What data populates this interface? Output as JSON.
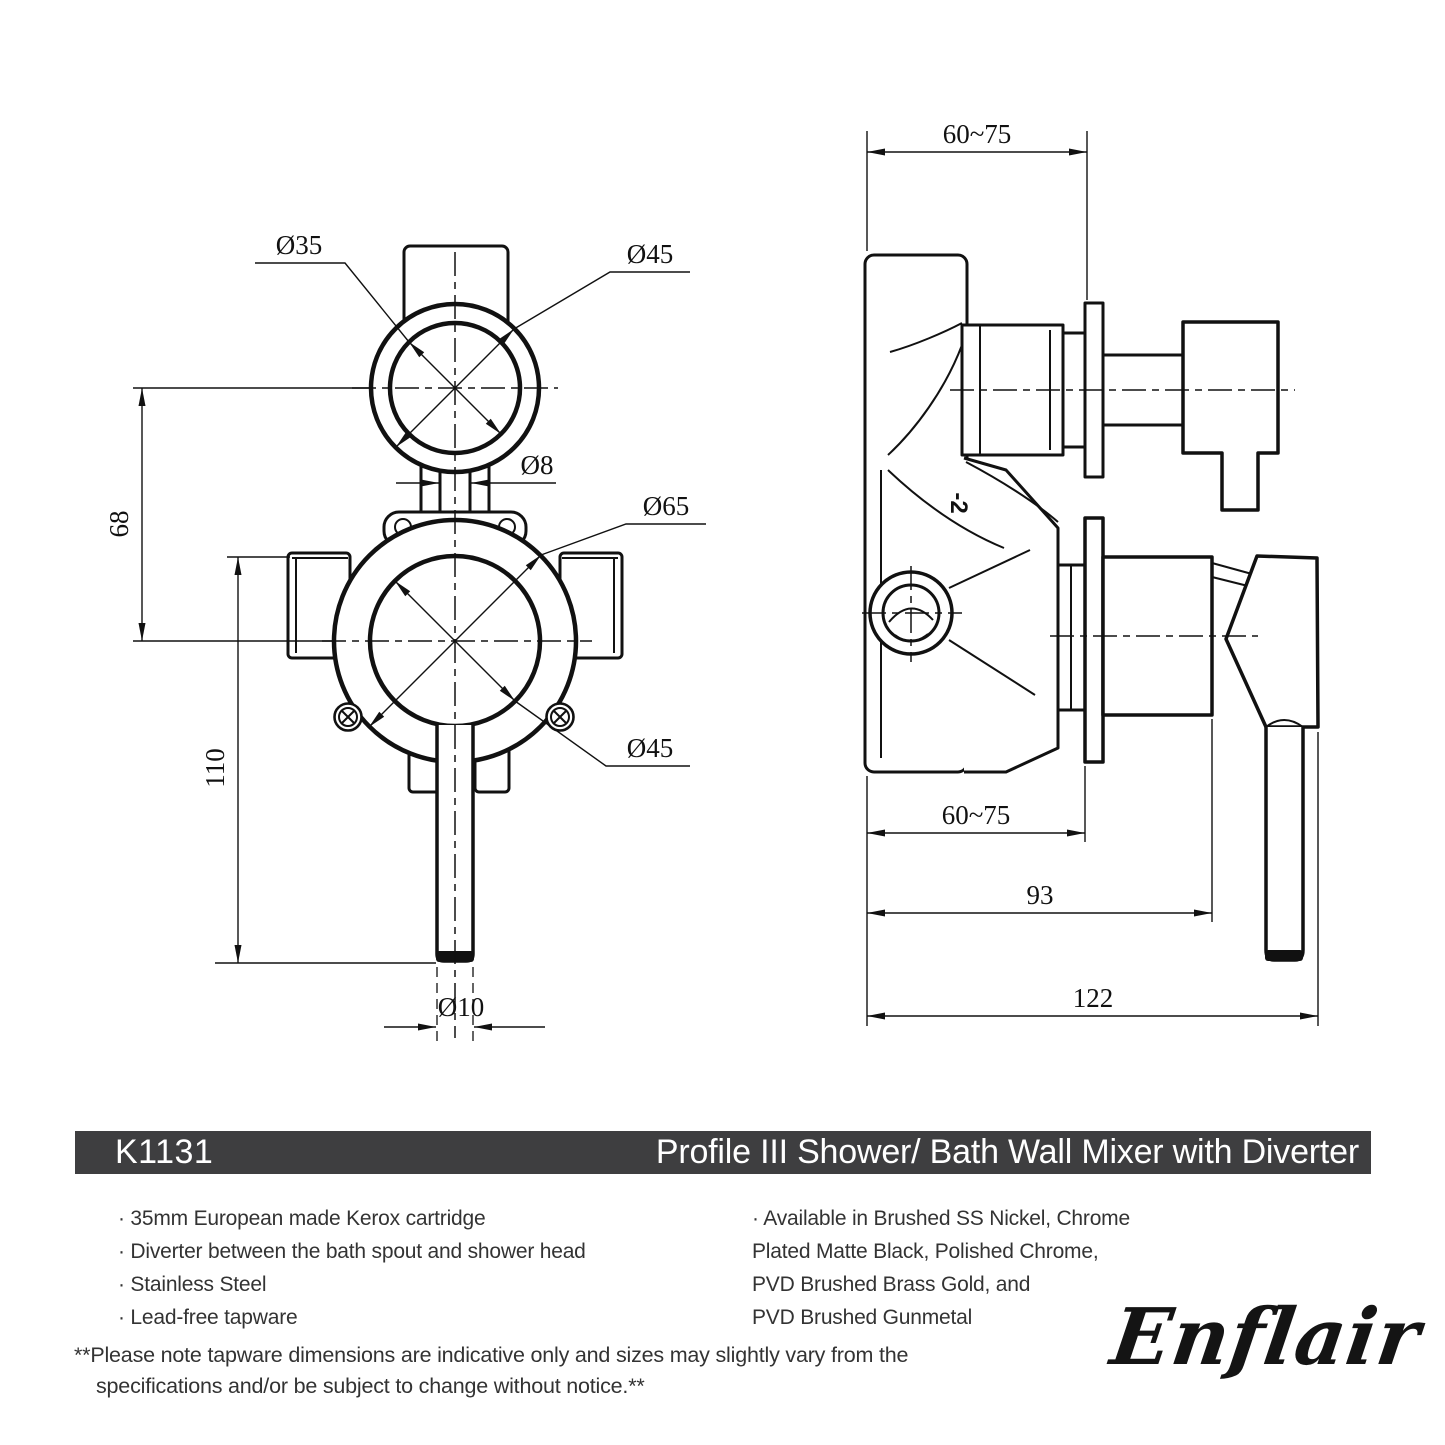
{
  "header": {
    "code": "K1131",
    "title": "Profile III Shower/ Bath Wall Mixer with Diverter"
  },
  "features_left": [
    "· 35mm European made Kerox cartridge",
    "· Diverter between the bath spout and shower head",
    "· Stainless Steel",
    "· Lead-free tapware"
  ],
  "features_right": [
    "· Available in Brushed SS Nickel, Chrome",
    "Plated Matte Black, Polished Chrome,",
    "PVD Brushed Brass Gold, and",
    "PVD Brushed Gunmetal"
  ],
  "disclaimer": {
    "line1": "**Please note tapware dimensions are indicative only and sizes may slightly vary from the",
    "line2": "specifications and/or be subject to change without notice.**"
  },
  "brand": {
    "logo": "Enflair"
  },
  "drawing": {
    "front": {
      "dia_top_inner": "Ø35",
      "dia_top_outer": "Ø45",
      "dia_stem": "Ø8",
      "dia_body_outer": "Ø65",
      "dia_body_inner": "Ø45",
      "dia_rod": "Ø10",
      "height_offset": "68",
      "height_total": "110"
    },
    "side": {
      "depth_top": "60~75",
      "depth_bottom": "60~75",
      "width_cartridge": "93",
      "width_total": "122",
      "marking": "-2"
    }
  },
  "colors": {
    "banner_bg": "#3E3E40",
    "ink": "#111111",
    "text": "#333333"
  }
}
